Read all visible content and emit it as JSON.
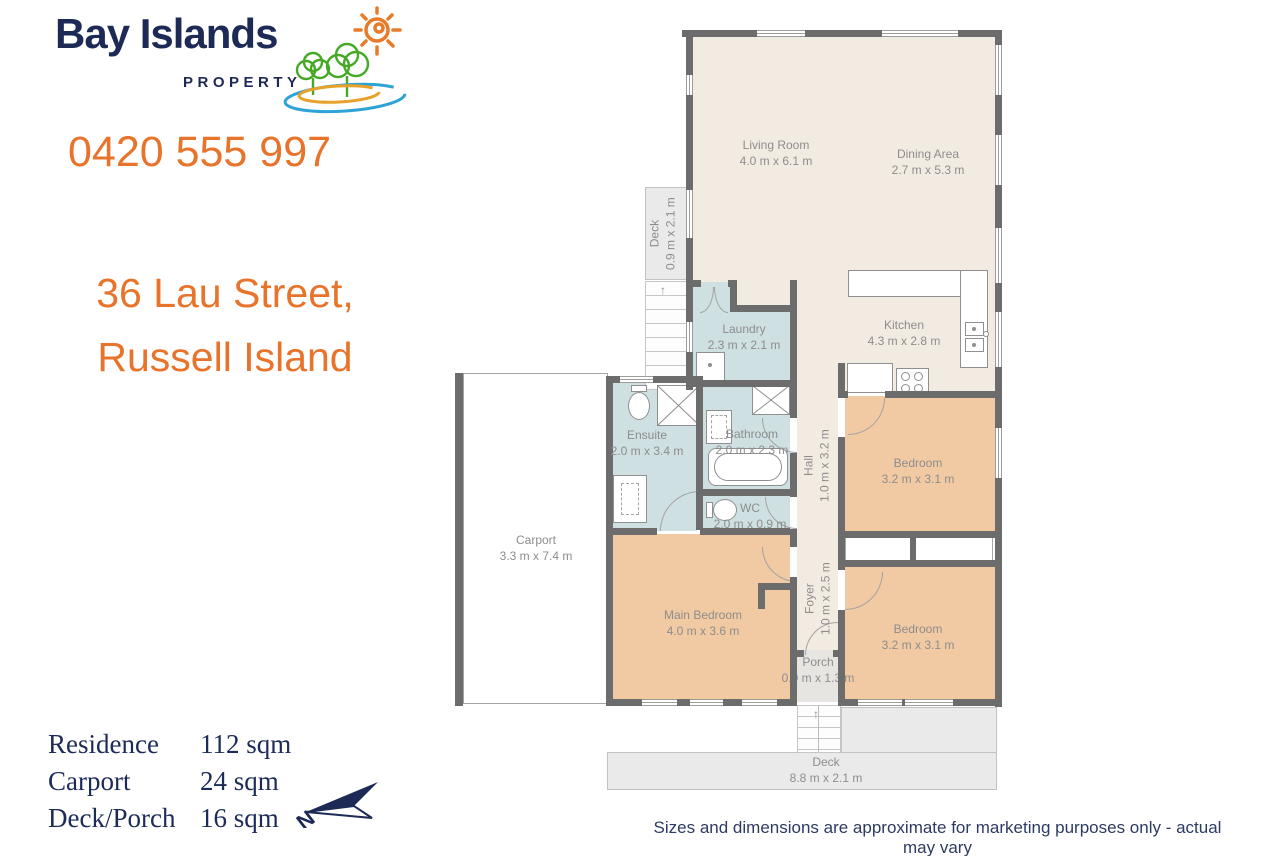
{
  "brand": {
    "title": "Bay Islands",
    "subtitle": "PROPERTY"
  },
  "contact": {
    "phone": "0420 555 997"
  },
  "listing": {
    "address_line1": "36 Lau Street,",
    "address_line2": "Russell Island"
  },
  "area_table": {
    "rows": [
      {
        "label": "Residence",
        "value": "112 sqm"
      },
      {
        "label": "Carport",
        "value": "24 sqm"
      },
      {
        "label": "Deck/Porch",
        "value": "16 sqm"
      }
    ]
  },
  "compass": {
    "north_label": "N"
  },
  "disclaimer": "Sizes and dimensions are approximate for marketing purposes only - actual may vary",
  "floorplan": {
    "stairs_arrow": "↑",
    "rooms": {
      "living_room": {
        "name": "Living Room",
        "dims": "4.0 m x 6.1 m"
      },
      "dining_area": {
        "name": "Dining Area",
        "dims": "2.7 m x 5.3 m"
      },
      "kitchen": {
        "name": "Kitchen",
        "dims": "4.3 m x 2.8 m"
      },
      "deck_upper": {
        "name": "Deck",
        "dims": "0.9 m x 2.1 m"
      },
      "laundry": {
        "name": "Laundry",
        "dims": "2.3 m x 2.1 m"
      },
      "ensuite": {
        "name": "Ensuite",
        "dims": "2.0 m x 3.4 m"
      },
      "bathroom": {
        "name": "Bathroom",
        "dims": "2.0 m x 2.3 m"
      },
      "wc": {
        "name": "WC",
        "dims": "2.0 m x 0.9 m"
      },
      "hall": {
        "name": "Hall",
        "dims": "1.0 m x 3.2 m"
      },
      "bedroom_1": {
        "name": "Bedroom",
        "dims": "3.2 m x 3.1 m"
      },
      "carport": {
        "name": "Carport",
        "dims": "3.3 m x 7.4 m"
      },
      "main_bedroom": {
        "name": "Main Bedroom",
        "dims": "4.0 m x 3.6 m"
      },
      "foyer": {
        "name": "Foyer",
        "dims": "1.0 m x 2.5 m"
      },
      "bedroom_2": {
        "name": "Bedroom",
        "dims": "3.2 m x 3.1 m"
      },
      "porch": {
        "name": "Porch",
        "dims": "0.9 m x 1.3 m"
      },
      "deck_lower": {
        "name": "Deck",
        "dims": "8.8 m x 2.1 m"
      }
    }
  },
  "colors": {
    "accent_orange": "#E8742C",
    "brand_navy": "#1E2A56",
    "wall_gray": "#6C6C6C",
    "room_cream": "#F2EBE2",
    "room_wet_blue": "#CFE0E2",
    "room_bed_tan": "#F1CAA3",
    "deck_gray": "#EAEAEA",
    "label_gray": "#8D8D8D"
  }
}
